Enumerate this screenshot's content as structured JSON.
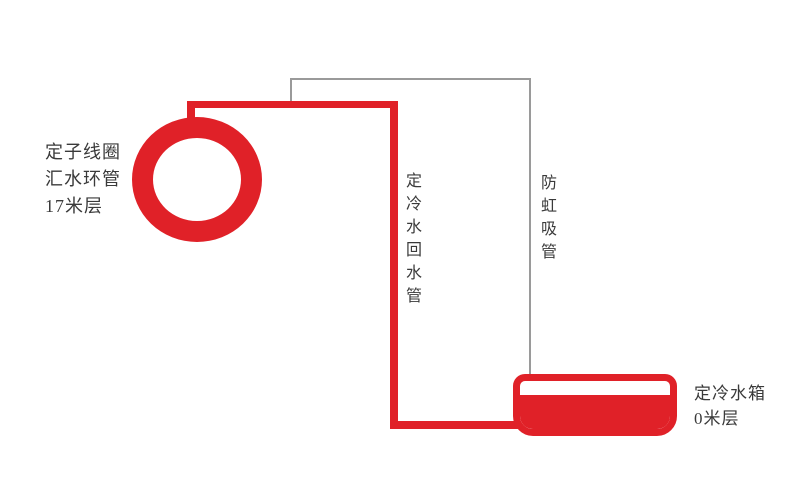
{
  "diagram": {
    "ring_label": {
      "line1": "定子线圈",
      "line2": "汇水环管",
      "line3": "17米层"
    },
    "return_pipe_label": "定冷水回水管",
    "anti_siphon_label": "防虹吸管",
    "tank_label": {
      "line1": "定冷水箱",
      "line2": "0米层"
    },
    "colors": {
      "pipe_red": "#e02128",
      "anti_siphon_line_gray": "#9a9a9a",
      "label_text": "#3a3a3a",
      "background": "#ffffff"
    }
  }
}
